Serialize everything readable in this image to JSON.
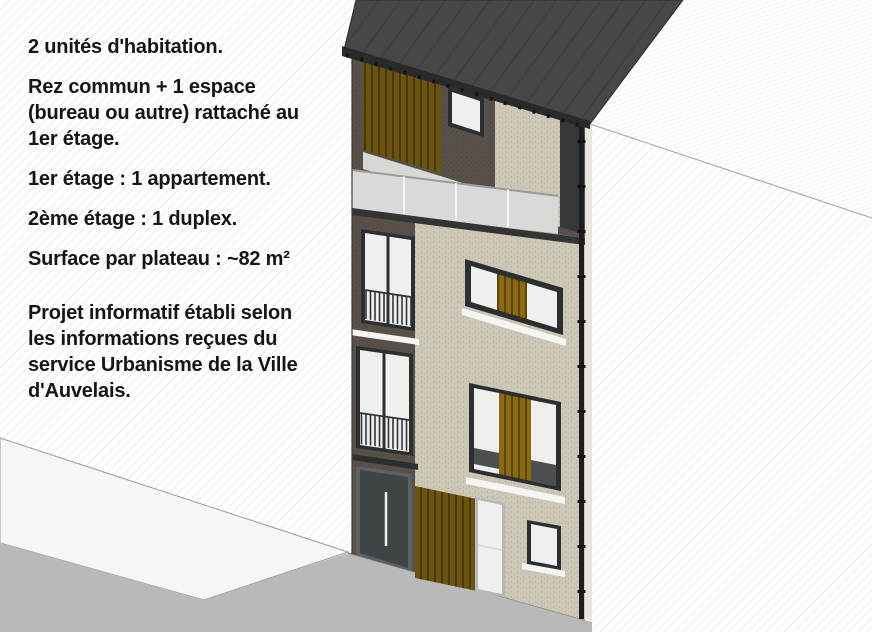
{
  "notes": {
    "lines": [
      "2 unités d'habitation.",
      "Rez commun + 1 espace",
      "(bureau ou autre) rattaché au",
      "1er étage.",
      "1er étage : 1 appartement.",
      "2ème étage : 1 duplex.",
      "Surface par plateau : ~82 m²",
      "Projet informatif établi selon",
      "les informations reçues du",
      "service Urbanisme de la Ville",
      "d'Auvelais."
    ]
  },
  "colors": {
    "bg": "#ffffff",
    "text": "#161616",
    "hatch_line": "#d4d4d4",
    "hatch_fine": "#e2e2e2",
    "line_gray": "#a0a0a0",
    "sidewalk": "#f6f6f6",
    "street": "#b9b9b9",
    "base_shadow": "#8b8b8b",
    "roof": "#474747",
    "roof_seam": "#383838",
    "fascia": "#2a2a2a",
    "gutter": "#141414",
    "brick": "#ccc7b6",
    "brick_dot": "#bab5a2",
    "dark_wall": "#575149",
    "dark_wall_dot": "#4b463f",
    "wood_dark": "#6b5310",
    "wood_dark_line": "#41320a",
    "wood_gold": "#8a690f",
    "wood_gold_line": "#4e3c08",
    "frame_dark": "#2c2f31",
    "glass": "#eff0ee",
    "railing": "#30343a",
    "balustrade": "#d9dad8",
    "balustrade_rail": "#9a9c9a",
    "divider": "#f4f4f4",
    "slab": "#343434",
    "floor": "#d7d7d5",
    "spandrel": "#4b4f52",
    "sill": "#f5f5f3",
    "door": "#3f4447",
    "door_frame": "#5c6165",
    "handle": "#eeeeee",
    "door_light_frame": "#b7bab8",
    "corner_glazing": "#35383b",
    "downspout": "#1d1d1d",
    "edge_sliver": "#e7e5dd",
    "left_edge": "#3f3c37"
  }
}
